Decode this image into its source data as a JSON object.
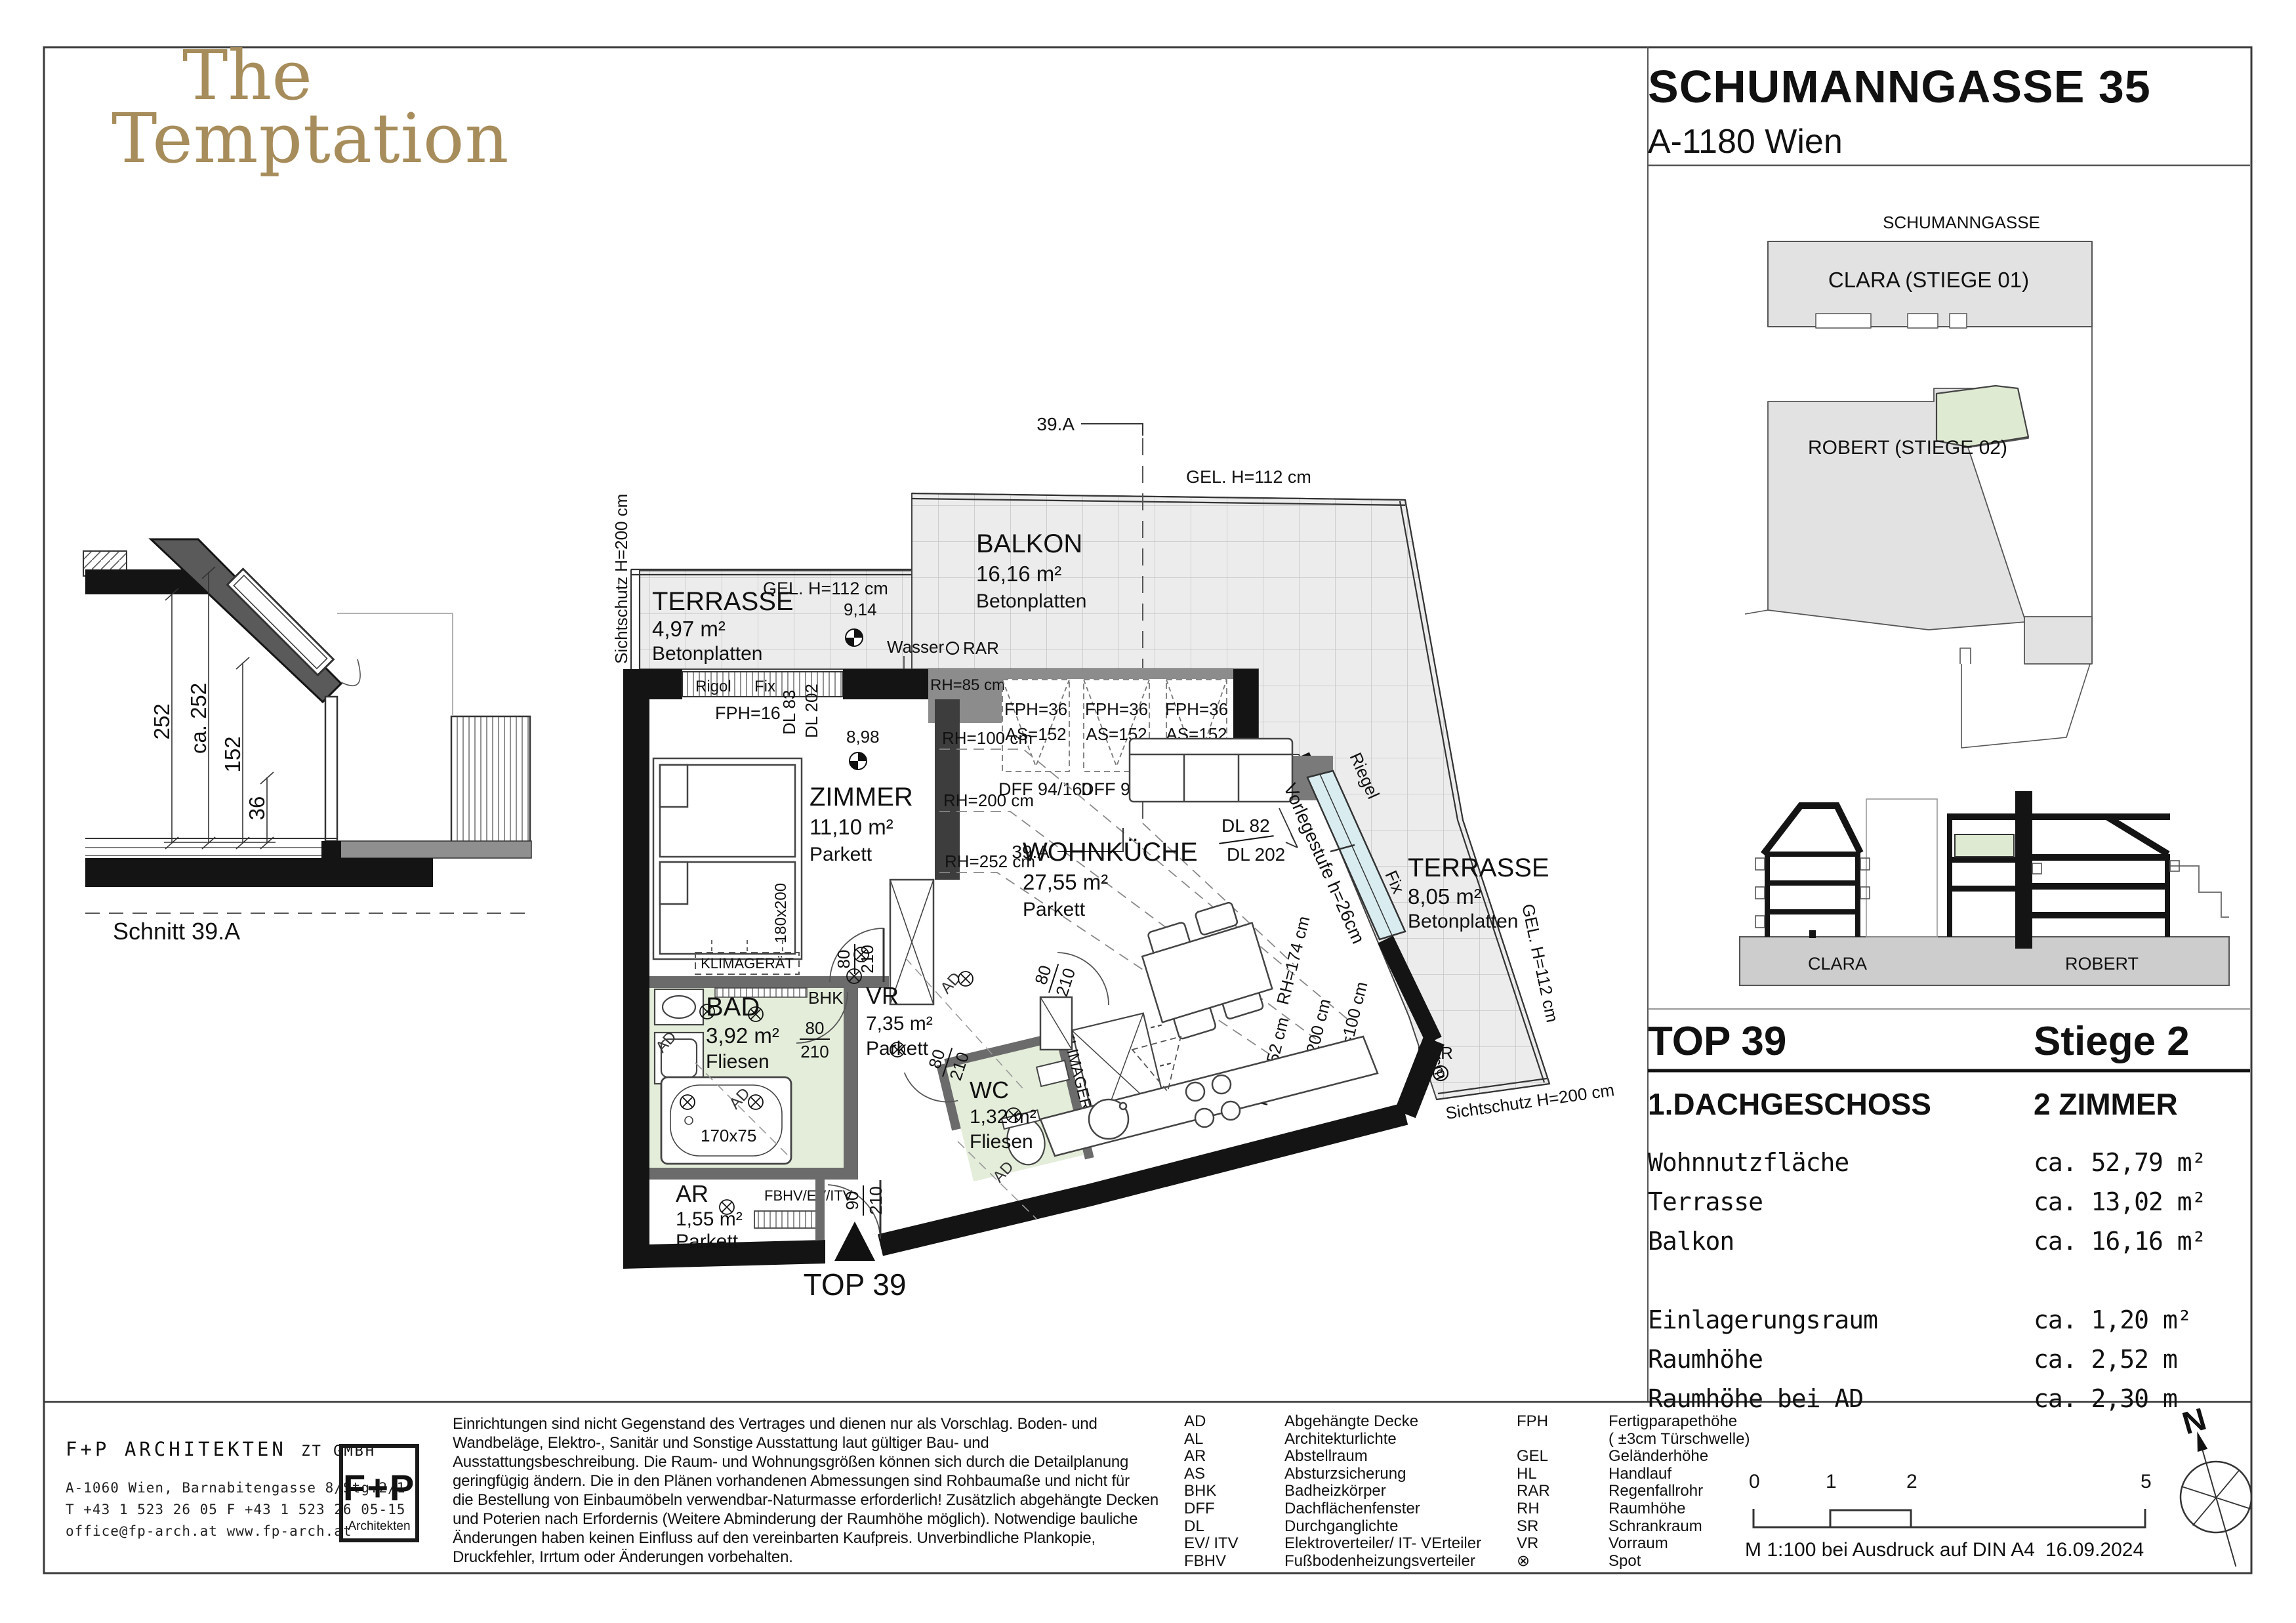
{
  "logo": {
    "line1": "The",
    "line2": "Temptation"
  },
  "header": {
    "title": "SCHUMANNGASSE 35",
    "subtitle": "A-1180 Wien"
  },
  "site": {
    "street": "SCHUMANNGASSE",
    "clara": "CLARA (STIEGE 01)",
    "robert": "ROBERT (STIEGE 02)"
  },
  "section": {
    "label": "Schnitt 39.A",
    "d1": "252",
    "d2": "ca. 252",
    "d3": "152",
    "d4": "36"
  },
  "elevation": {
    "clara": "CLARA",
    "robert": "ROBERT"
  },
  "info": {
    "top": "TOP 39",
    "stiege": "Stiege 2",
    "floor": "1.DACHGESCHOSS",
    "rooms": "2 ZIMMER",
    "rows": [
      {
        "label": "Wohnnutzfläche",
        "value": "ca. 52,79 m²"
      },
      {
        "label": "Terrasse",
        "value": "ca. 13,02 m²"
      },
      {
        "label": "Balkon",
        "value": "ca. 16,16 m²"
      },
      {
        "label": "Einlagerungsraum",
        "value": "ca. 1,20 m²"
      },
      {
        "label": "Raumhöhe",
        "value": "ca. 2,52 m"
      },
      {
        "label": "Raumhöhe bei AD",
        "value": "ca. 2,30 m"
      }
    ]
  },
  "plan": {
    "unit": "TOP 39",
    "section_mark": "39.A",
    "terr1": {
      "name": "TERRASSE",
      "area": "4,97 m²",
      "floor": "Betonplatten"
    },
    "balkon": {
      "name": "BALKON",
      "area": "16,16 m²",
      "floor": "Betonplatten"
    },
    "terr2": {
      "name": "TERRASSE",
      "area": "8,05 m²",
      "floor": "Betonplatten"
    },
    "zimmer": {
      "name": "ZIMMER",
      "area": "11,10 m²",
      "floor": "Parkett"
    },
    "wk": {
      "name": "WOHNKÜCHE",
      "area": "27,55 m²",
      "floor": "Parkett"
    },
    "bad": {
      "name": "BAD",
      "area": "3,92 m²",
      "floor": "Fliesen"
    },
    "vr": {
      "name": "VR",
      "area": "7,35 m²",
      "floor": "Parkett"
    },
    "wc": {
      "name": "WC",
      "area": "1,32 m²",
      "floor": "Fliesen"
    },
    "ar": {
      "name": "AR",
      "area": "1,55 m²",
      "floor": "Parkett"
    },
    "gel112": "GEL. H=112 cm",
    "sicht200": "Sichtschutz H=200 cm",
    "rigol": "Rigol",
    "fix": "Fix",
    "riegel": "Riegel",
    "wasser": "Wasser",
    "rar": "RAR",
    "rh85": "RH=85 cm",
    "rh100": "RH=100 cm",
    "rh200": "RH=200 cm",
    "rh252": "RH=252 cm",
    "rh174": "RH=174 cm",
    "fph16": "FPH=16",
    "fph36": "FPH=36",
    "as152": "AS=152",
    "dff": "DFF 94/160",
    "dl83": "DL 83",
    "dl202": "DL 202",
    "dl82": "DL 82",
    "vorlegestufe": "Vorlegestufe h=26cm",
    "klima": "KLIMAGERÄT",
    "bhk": "BHK",
    "fbhv": "FBHV/EV/ITV",
    "bed": "180x200",
    "tub": "170x75",
    "ad": "AD",
    "p914": "9,14",
    "p898": "8,98",
    "d80": "80",
    "d90": "90",
    "d210": "210"
  },
  "legend": {
    "col1": [
      {
        "abbr": "AD",
        "desc": "Abgehängte Decke"
      },
      {
        "abbr": "AL",
        "desc": "Architekturlichte"
      },
      {
        "abbr": "AR",
        "desc": "Abstellraum"
      },
      {
        "abbr": "AS",
        "desc": "Absturzsicherung"
      },
      {
        "abbr": "BHK",
        "desc": "Badheizkörper"
      },
      {
        "abbr": "DFF",
        "desc": "Dachflächenfenster"
      },
      {
        "abbr": "DL",
        "desc": "Durchganglichte"
      },
      {
        "abbr": "EV/ ITV",
        "desc": "Elektroverteiler/ IT- VErteiler"
      },
      {
        "abbr": "FBHV",
        "desc": "Fußbodenheizungsverteiler"
      }
    ],
    "col2": [
      {
        "abbr": "FPH",
        "desc": "Fertigparapethöhe"
      },
      {
        "abbr": "",
        "desc": "( ±3cm Türschwelle)"
      },
      {
        "abbr": "GEL",
        "desc": "Geländerhöhe"
      },
      {
        "abbr": "HL",
        "desc": "Handlauf"
      },
      {
        "abbr": "RAR",
        "desc": "Regenfallrohr"
      },
      {
        "abbr": "RH",
        "desc": "Raumhöhe"
      },
      {
        "abbr": "SR",
        "desc": "Schrankraum"
      },
      {
        "abbr": "VR",
        "desc": "Vorraum"
      },
      {
        "abbr": "⊗",
        "desc": "Spot"
      }
    ]
  },
  "footer": {
    "firm": "F+P ARCHITEKTEN",
    "firm_suffix": "ZT GMBH",
    "addr1": "A-1060 Wien, Barnabitengasse 8/Stg.2/1",
    "addr2": "T +43 1 523 26 05   F +43 1 523 26 05-15",
    "addr3": "office@fp-arch.at     www.fp-arch.at",
    "logo_top": "F+P",
    "logo_bottom": "Architekten",
    "disclaimer": "Einrichtungen sind nicht Gegenstand des Vertrages und dienen nur als Vorschlag. Boden- und\nWandbeläge, Elektro-, Sanitär und Sonstige Ausstattung laut gültiger Bau- und\nAusstattungsbeschreibung. Die Raum- und Wohnungsgrößen können sich durch die Detailplanung\ngeringfügig ändern. Die in den Plänen vorhandenen Abmessungen sind Rohbaumaße und nicht für\ndie Bestellung von Einbaumöbeln  verwendbar-Naturmasse erforderlich! Zusätzlich abgehängte Decken\nund Poterien nach Erfordernis (Weitere Abminderung der Raumhöhe möglich). Notwendige bauliche\nÄnderungen haben keinen Einfluss auf den vereinbarten Kaufpreis. Unverbindliche Plankopie,\nDruckfehler, Irrtum oder Änderungen vorbehalten.",
    "scale": {
      "t0": "0",
      "t1": "1",
      "t2": "2",
      "t5": "5",
      "note": "M 1:100 bei Ausdruck auf DIN A4",
      "date": "16.09.2024"
    },
    "north": "N"
  }
}
